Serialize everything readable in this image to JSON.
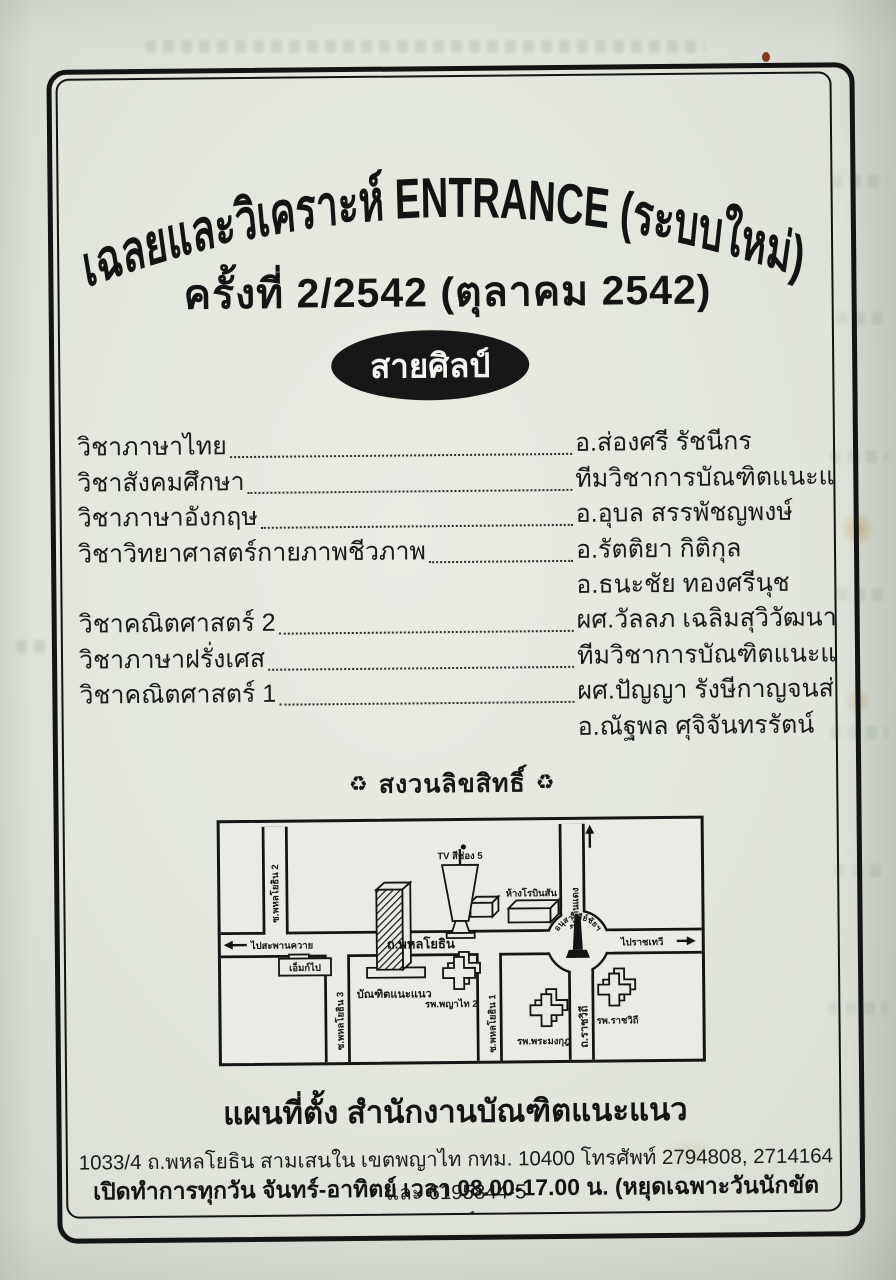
{
  "page": {
    "title": "เฉลยและวิเคราะห์ ENTRANCE (ระบบใหม่)",
    "edition": "ครั้งที่ 2/2542 (ตุลาคม 2542)",
    "track": "สายศิลป์",
    "copyright_symbol": "♻",
    "copyright": "สงวนลิขสิทธิ์"
  },
  "subjects": [
    {
      "subject": "วิชาภาษาไทย",
      "author": "อ.ส่องศรี รัชนีกร"
    },
    {
      "subject": "วิชาสังคมศึกษา",
      "author": "ทีมวิชาการบัณฑิตแนะแนว"
    },
    {
      "subject": "วิชาภาษาอังกฤษ",
      "author": "อ.อุบล สรรพัชญพงษ์"
    },
    {
      "subject": "วิชาวิทยาศาสตร์กายภาพชีวภาพ",
      "author": "อ.รัตติยา กิติกุล",
      "author2": "อ.ธนะชัย ทองศรีนุช"
    },
    {
      "subject": "วิชาคณิตศาสตร์ 2",
      "author": "ผศ.วัลลภ เฉลิมสุวิวัฒนาการ"
    },
    {
      "subject": "วิชาภาษาฝรั่งเศส",
      "author": "ทีมวิชาการบัณฑิตแนะแนว"
    },
    {
      "subject": "วิชาคณิตศาสตร์ 1",
      "author": "ผศ.ปัญญา รังษีกาญจนส่อง",
      "author2": "อ.ณัฐพล ศุจิจันทรรัตน์"
    }
  ],
  "map": {
    "labels": {
      "soi2": "ซ.พหลโยธิน 2",
      "tv_channel5": "TV สีช่อง 5",
      "robinson": "ห้างโรบินสัน",
      "to_dindaeng": "ไปดินแดง",
      "victory_monument": "อนุสาวรีย์ชัยฯ",
      "to_ratchathewi": "ไปราชเทวี",
      "phahonyothin_road": "ถ.พหลโยธิน",
      "to_saphankhwai": "ไปสะพานควาย",
      "em_building": "เอ็มก์ไป",
      "soi3": "ซ.พหลโยธิน 3",
      "bundit_naenaew": "บัณฑิตแนะแนว",
      "phyathai2_hospital": "รพ.พญาไท 2",
      "soi1": "ซ.พหลโยธิน 1",
      "phramongkut_hospital": "รพ.พระมงกุฎ",
      "ratchawithi_road": "ถ.ราชวิถี",
      "rajavithi_hospital": "รพ.ราชวิถี"
    }
  },
  "footer": {
    "map_heading": "แผนที่ตั้ง สำนักงานบัณฑิตแนะแนว",
    "address": "1033/4 ถ.พหลโยธิน สามเสนใน เขตพญาไท กทม. 10400 โทรศัพท์ 2794808, 2714164 และ 6195844-5",
    "hours": "เปิดทำการทุกวัน จันทร์-อาทิตย์ เวลา 08.00-17.00 น. (หยุดเฉพาะวันนักขัตฤกษ์)"
  },
  "colors": {
    "ink": "#141414",
    "paper": "#dfe4da",
    "badge_bg": "#171717",
    "badge_text": "#f4f5f1"
  }
}
